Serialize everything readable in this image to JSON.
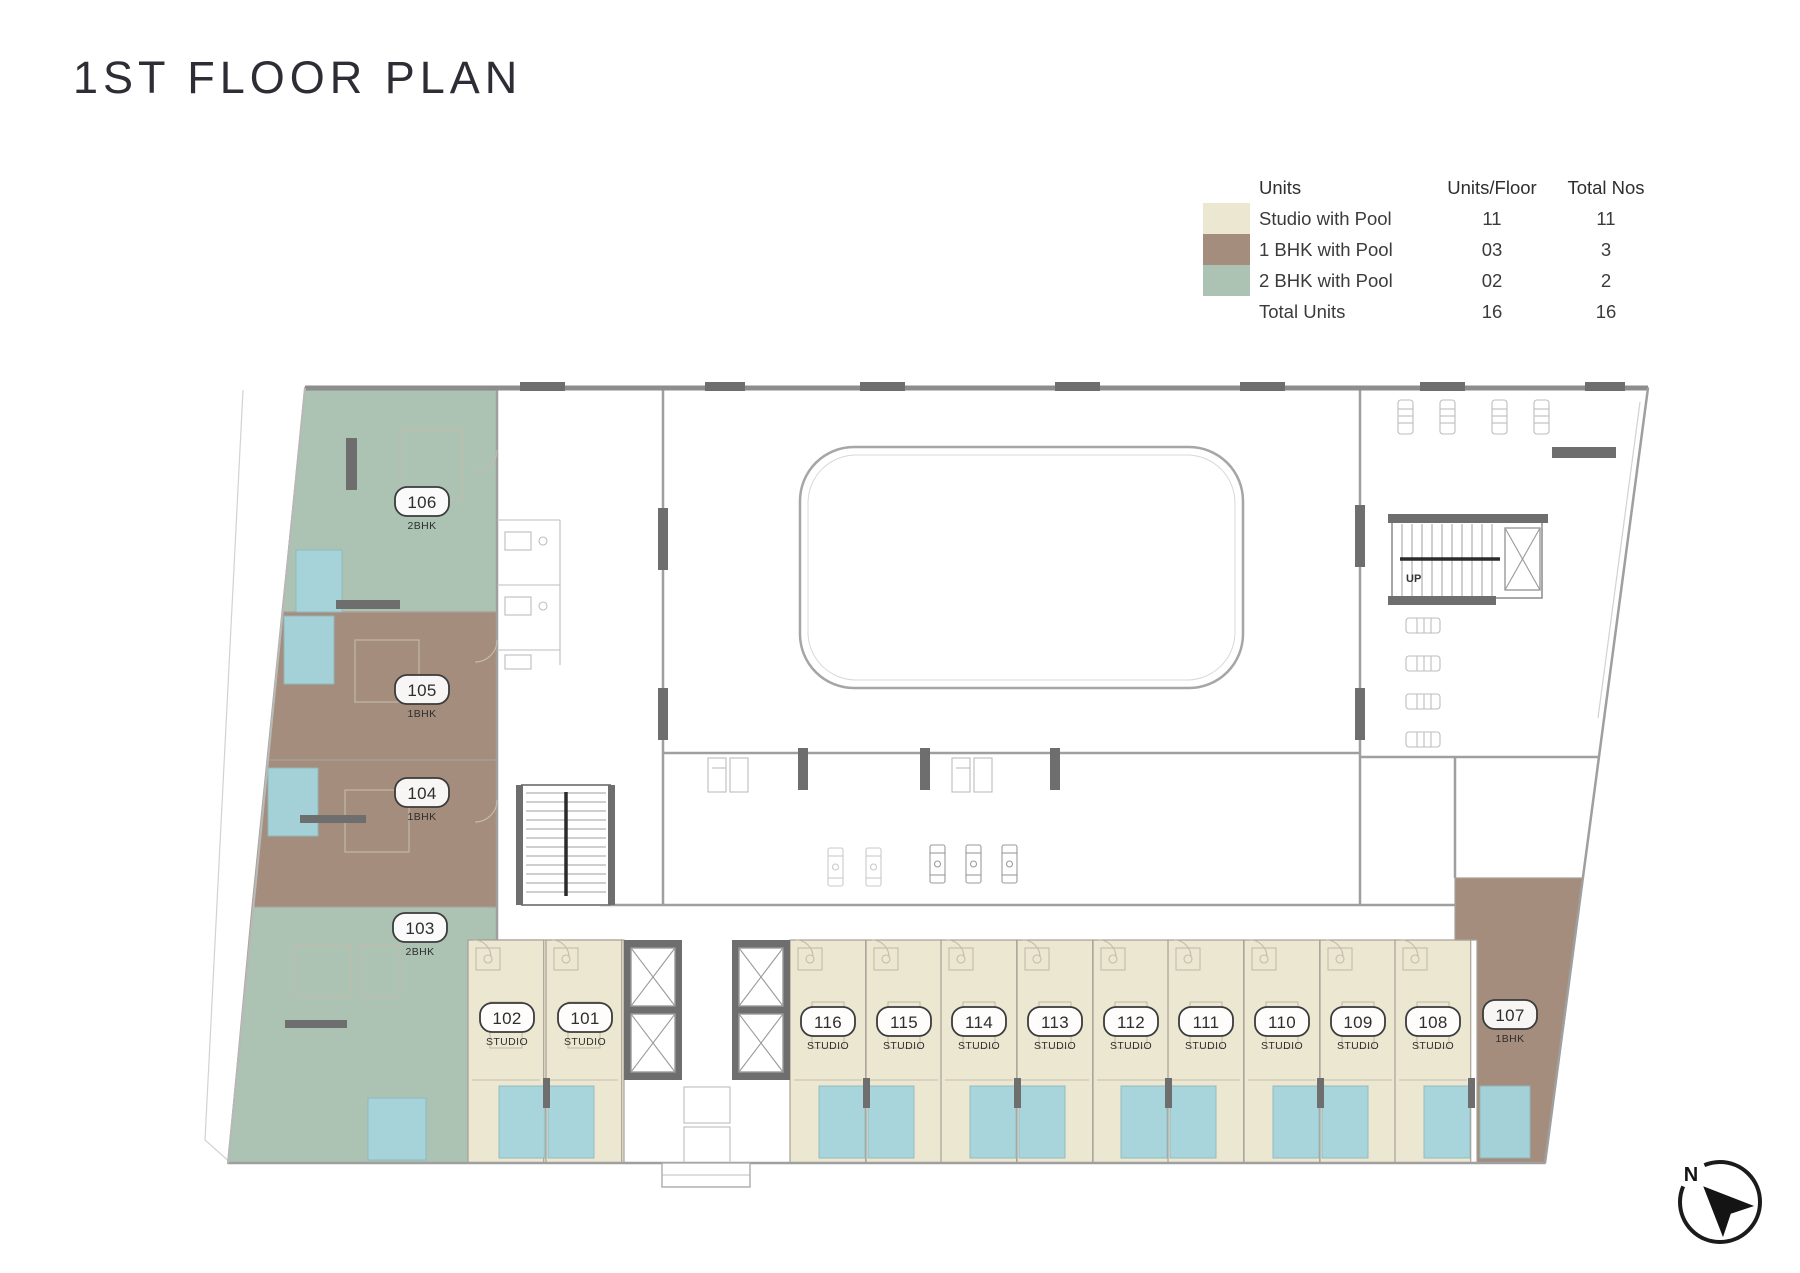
{
  "title": "1ST FLOOR PLAN",
  "legend": {
    "headers": {
      "units": "Units",
      "units_per_floor": "Units/Floor",
      "total_nos": "Total Nos"
    },
    "rows": [
      {
        "label": "Studio with Pool",
        "units_per_floor": "11",
        "total_nos": "11",
        "color": "#ECE7D1"
      },
      {
        "label": "1 BHK with Pool",
        "units_per_floor": "03",
        "total_nos": "3",
        "color": "#A48D7C"
      },
      {
        "label": "2 BHK with Pool",
        "units_per_floor": "02",
        "total_nos": "2",
        "color": "#ACC2B2"
      }
    ],
    "total_row": {
      "label": "Total Units",
      "units_per_floor": "16",
      "total_nos": "16"
    }
  },
  "plan": {
    "colors": {
      "studio": "#ECE7D1",
      "one_bhk": "#A48D7C",
      "two_bhk": "#ACC2B2",
      "pool": "#A5D4DC",
      "wall_dark": "#6E6E6E"
    },
    "stair_label": "UP",
    "compass_label": "N",
    "units": [
      {
        "number": "106",
        "type": "2BHK"
      },
      {
        "number": "105",
        "type": "1BHK"
      },
      {
        "number": "104",
        "type": "1BHK"
      },
      {
        "number": "103",
        "type": "2BHK"
      },
      {
        "number": "102",
        "type": "STUDIO"
      },
      {
        "number": "101",
        "type": "STUDIO"
      },
      {
        "number": "116",
        "type": "STUDIO"
      },
      {
        "number": "115",
        "type": "STUDIO"
      },
      {
        "number": "114",
        "type": "STUDIO"
      },
      {
        "number": "113",
        "type": "STUDIO"
      },
      {
        "number": "112",
        "type": "STUDIO"
      },
      {
        "number": "111",
        "type": "STUDIO"
      },
      {
        "number": "110",
        "type": "STUDIO"
      },
      {
        "number": "109",
        "type": "STUDIO"
      },
      {
        "number": "108",
        "type": "STUDIO"
      },
      {
        "number": "107",
        "type": "1BHK"
      }
    ]
  }
}
